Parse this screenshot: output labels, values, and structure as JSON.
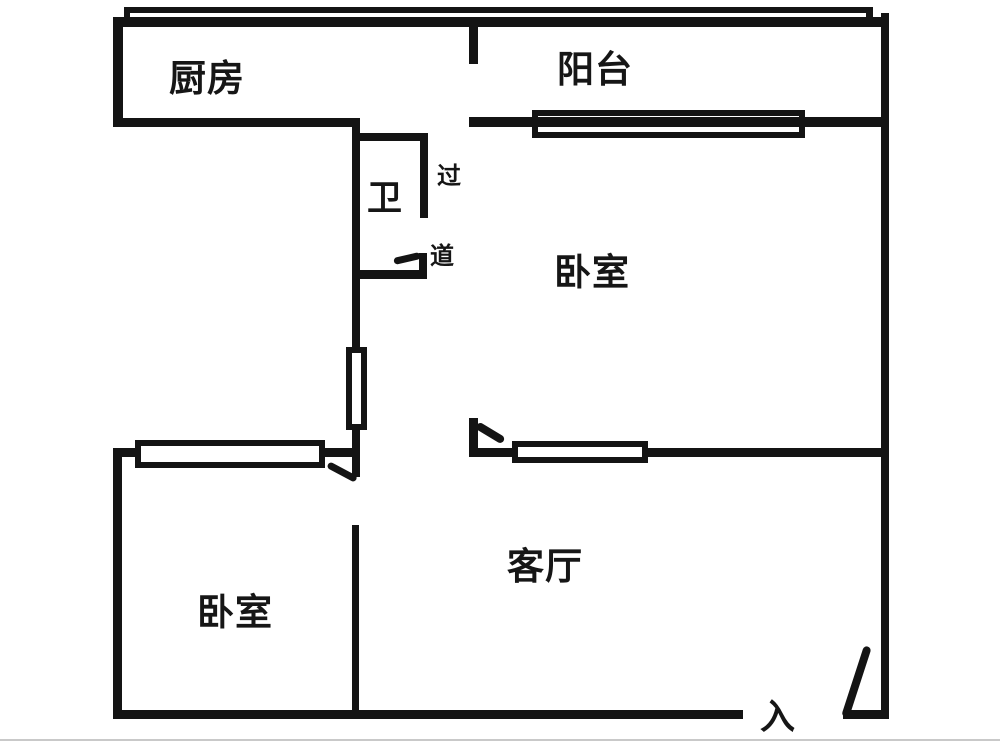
{
  "floorplan": {
    "type": "apartment-floor-plan",
    "rooms": {
      "kitchen": {
        "label": "厨房"
      },
      "balcony": {
        "label": "阳台"
      },
      "bathroom": {
        "label": "卫"
      },
      "corridor": {
        "label_char_top": "过",
        "label_char_bottom": "道"
      },
      "bedroom_top_right": {
        "label": "卧室"
      },
      "bedroom_bottom_left": {
        "label": "卧室"
      },
      "living_room": {
        "label": "客厅"
      },
      "entrance": {
        "label": "入"
      }
    },
    "colors": {
      "wall": "#141414",
      "window_fill": "#ffffff",
      "background": "#ffffff",
      "page_edge_line": "#c9c9c9",
      "text": "#161616"
    }
  }
}
